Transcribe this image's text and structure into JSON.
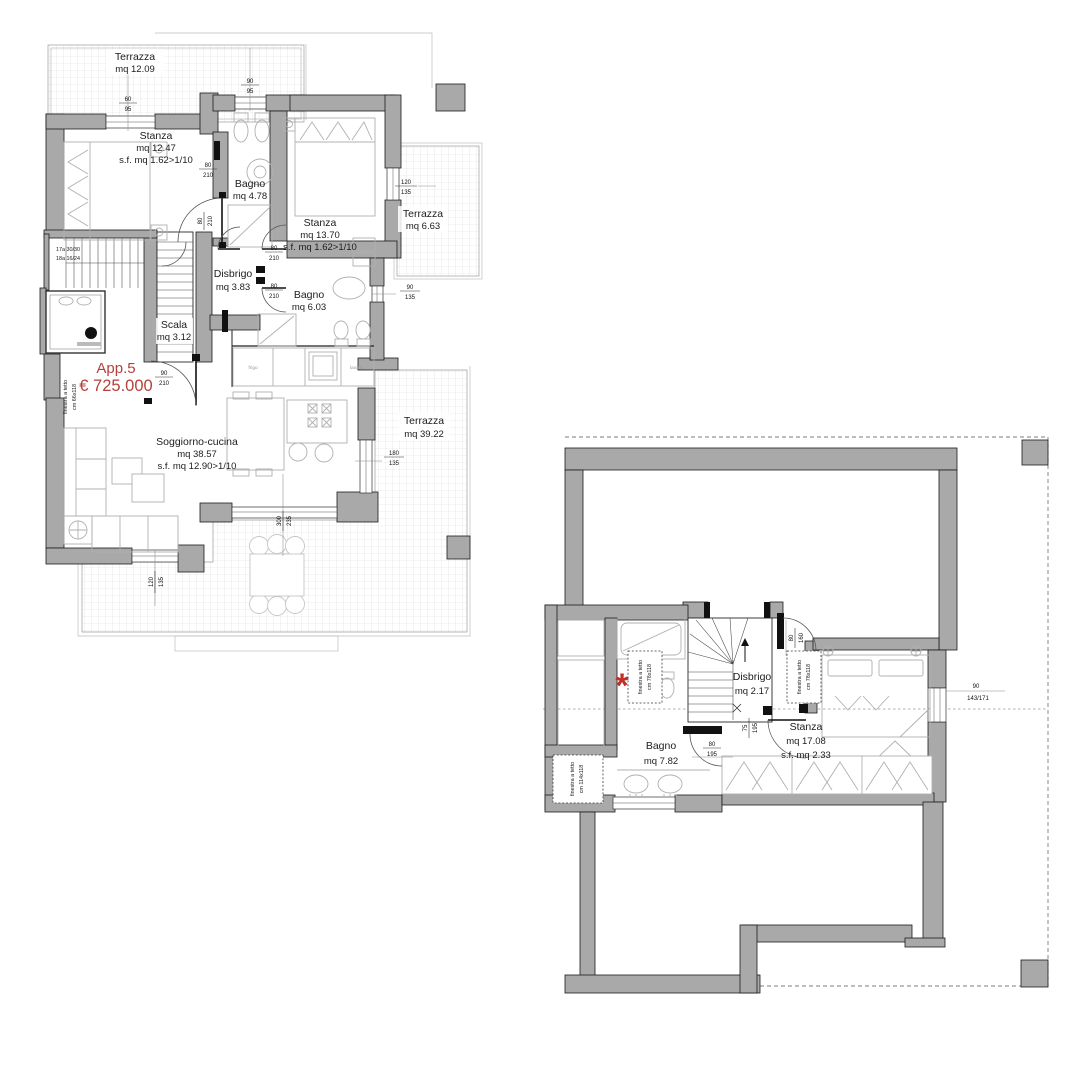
{
  "colors": {
    "wall_gray": "#a9a9a9",
    "accent_red": "#b5403a",
    "marker_red": "#c03028"
  },
  "plan_upper": {
    "apartment": {
      "name": "App.5",
      "price": "€ 725.000"
    },
    "rooms": {
      "terrace_top": {
        "name": "Terrazza",
        "area": "mq 12.09"
      },
      "bedroom_left": {
        "name": "Stanza",
        "area": "mq 12.47",
        "surface": "s.f. mq 1.62>1/10"
      },
      "bath_top": {
        "name": "Bagno",
        "area": "mq 4.78"
      },
      "bedroom_right": {
        "name": "Stanza",
        "area": "mq 13.70",
        "surface": "s.f. mq 1.62>1/10"
      },
      "terrace_right": {
        "name": "Terrazza",
        "area": "mq 6.63"
      },
      "hall": {
        "name": "Disbrigo",
        "area": "mq 3.83"
      },
      "bath_mid": {
        "name": "Bagno",
        "area": "mq 6.03"
      },
      "stair": {
        "name": "Scala",
        "area": "mq 3.12"
      },
      "living": {
        "name": "Soggiorno-cucina",
        "area": "mq 38.57",
        "surface": "s.f. mq 12.90>1/10"
      },
      "terrace_main": {
        "name": "Terrazza",
        "area": "mq 39.22"
      }
    },
    "stair_notes": {
      "line1": "17a 30/30",
      "line2": "18a 16/24"
    },
    "skylight_label": {
      "line1": "finestra a tetto",
      "line2": "cm 66x118"
    },
    "kitchen_labels": {
      "fridge": "frigo",
      "dishwasher": "lavast."
    },
    "dims": [
      {
        "t": "60",
        "b": "95"
      },
      {
        "t": "90",
        "b": "95"
      },
      {
        "t": "80",
        "b": "210"
      },
      {
        "t": "80",
        "b": "210"
      },
      {
        "t": "80",
        "b": "210"
      },
      {
        "t": "80",
        "b": "210"
      },
      {
        "t": "90",
        "b": "135"
      },
      {
        "t": "120",
        "b": "135"
      },
      {
        "t": "90",
        "b": "210"
      },
      {
        "t": "180",
        "b": "135"
      },
      {
        "t": "300",
        "b": "235"
      },
      {
        "t": "120",
        "b": "135"
      }
    ]
  },
  "plan_attic": {
    "rooms": {
      "hall": {
        "name": "Disbrigo",
        "area": "mq 2.17"
      },
      "bath": {
        "name": "Bagno",
        "area": "mq 7.82"
      },
      "bedroom": {
        "name": "Stanza",
        "area": "mq 17.08",
        "surface": "s.f. mq 2.33"
      }
    },
    "skylight_bath": {
      "line1": "finestra a tetto",
      "line2": "cm 78x118"
    },
    "skylight_bedroom": {
      "line1": "finestra a tetto",
      "line2": "cm 78x118"
    },
    "skylight_corner": {
      "line1": "finestra a tetto",
      "line2": "cm 114x118"
    },
    "marker": "*",
    "dims": [
      {
        "t": "80",
        "b": "160"
      },
      {
        "t": "75",
        "b": "195"
      },
      {
        "t": "80",
        "b": "195"
      },
      {
        "t": "90",
        "b": "143/171"
      }
    ]
  }
}
